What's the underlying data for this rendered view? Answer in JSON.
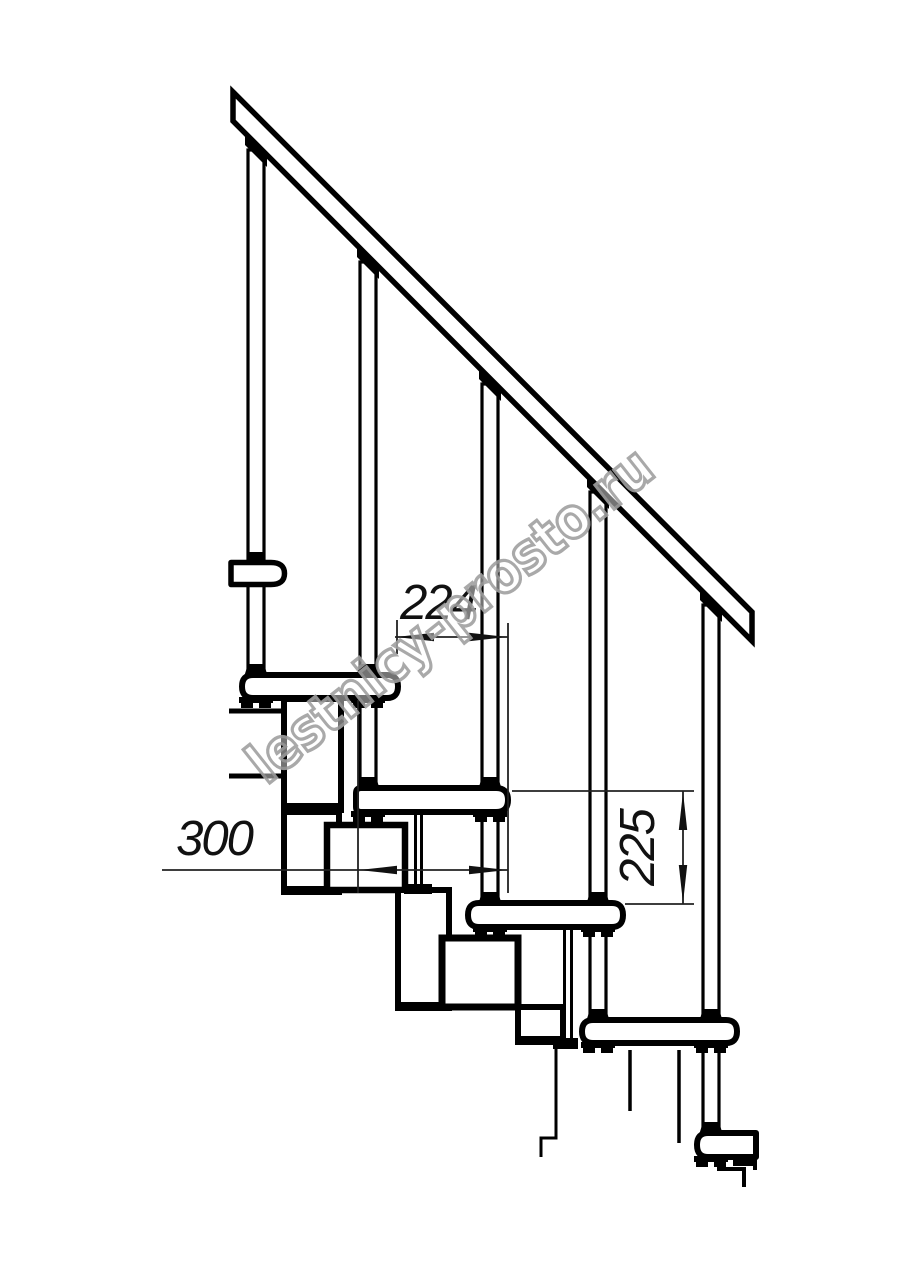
{
  "dimensions": {
    "step_run": {
      "label": "224"
    },
    "tread_depth": {
      "label": "300"
    },
    "step_rise": {
      "label": "225"
    }
  },
  "watermark": {
    "text": "lestnicy-prosto.ru"
  },
  "colors": {
    "background": "#ffffff",
    "drawing_lines": "#000000",
    "dimension_lines": "#222222",
    "dimension_text": "#111111",
    "watermark_gray": "#a0a0a0"
  }
}
